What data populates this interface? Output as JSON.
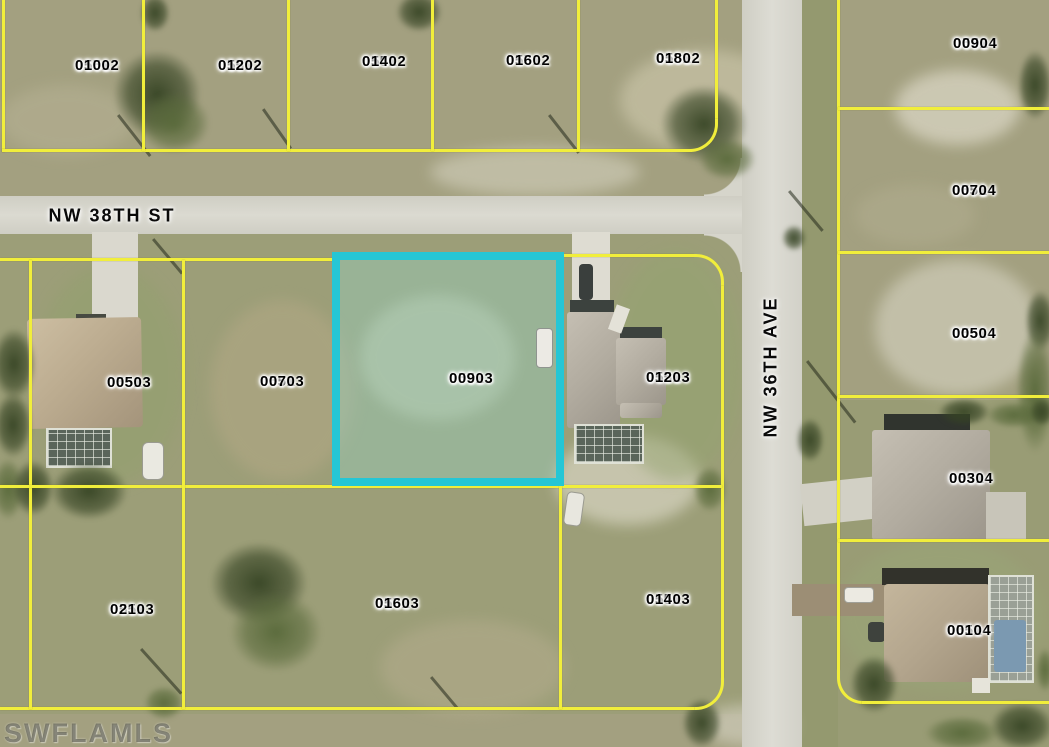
{
  "map": {
    "watermark": "SWFLAMLS",
    "highlighted_parcel_id": "05513 0090",
    "colors": {
      "parcel_line": "#f1ee3b",
      "highlight_border": "#25c6d5",
      "road": "#d6d5cb",
      "terrain": "#a3a080"
    },
    "streets": [
      {
        "name": "NW 38TH ST",
        "orientation": "horizontal"
      },
      {
        "name": "NW 36TH AVE",
        "orientation": "vertical"
      }
    ],
    "parcels": [
      {
        "id": "05512 0100",
        "block": "05512",
        "lot": "0100",
        "highlighted": false
      },
      {
        "id": "05512 0120",
        "block": "05512",
        "lot": "0120",
        "highlighted": false
      },
      {
        "id": "05512 0140",
        "block": "05512",
        "lot": "0140",
        "highlighted": false
      },
      {
        "id": "05512 0160",
        "block": "05512",
        "lot": "0160",
        "highlighted": false
      },
      {
        "id": "05512 0180",
        "block": "05512",
        "lot": "0180",
        "highlighted": false
      },
      {
        "id": "05514 0090",
        "block": "05514",
        "lot": "0090",
        "highlighted": false
      },
      {
        "id": "05514 0070",
        "block": "05514",
        "lot": "0070",
        "highlighted": false
      },
      {
        "id": "05514 0050",
        "block": "05514",
        "lot": "0050",
        "highlighted": false
      },
      {
        "id": "05513 0050",
        "block": "05513",
        "lot": "0050",
        "highlighted": false
      },
      {
        "id": "05513 0070",
        "block": "05513",
        "lot": "0070",
        "highlighted": false
      },
      {
        "id": "05513 0090",
        "block": "05513",
        "lot": "0090",
        "highlighted": true
      },
      {
        "id": "05513 0120",
        "block": "05513",
        "lot": "0120",
        "highlighted": false
      },
      {
        "id": "05514 0030",
        "block": "05514",
        "lot": "0030",
        "highlighted": false
      },
      {
        "id": "05513 0210",
        "block": "05513",
        "lot": "0210",
        "highlighted": false
      },
      {
        "id": "05513 0160",
        "block": "05513",
        "lot": "0160",
        "highlighted": false
      },
      {
        "id": "05513 0140",
        "block": "05513",
        "lot": "0140",
        "highlighted": false
      },
      {
        "id": "05514 0010",
        "block": "05514",
        "lot": "0010",
        "highlighted": false
      }
    ]
  }
}
